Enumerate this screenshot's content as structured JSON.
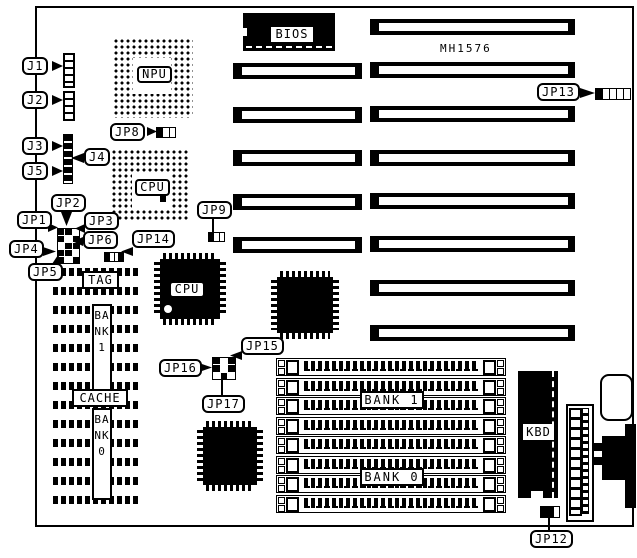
{
  "board": {
    "model": "MH1576"
  },
  "colors": {
    "ink": "#000000",
    "paper": "#ffffff"
  },
  "chips": {
    "bios": "BIOS",
    "npu": "NPU",
    "cpu_socket": "CPU",
    "cpu_qfp": "CPU",
    "tag": "TAG",
    "cache": "CACHE",
    "cache_bank1": "BANK1",
    "cache_bank0": "BANK0",
    "simm_bank1": "BANK 1",
    "simm_bank0": "BANK 0",
    "kbd": "KBD"
  },
  "connectors": {
    "j1": "J1",
    "j2": "J2",
    "j3": "J3",
    "j4": "J4",
    "j5": "J5"
  },
  "jumpers": {
    "jp1": "JP1",
    "jp2": "JP2",
    "jp3": "JP3",
    "jp4": "JP4",
    "jp5": "JP5",
    "jp6": "JP6",
    "jp8": "JP8",
    "jp9": "JP9",
    "jp12": "JP12",
    "jp13": "JP13",
    "jp14": "JP14",
    "jp15": "JP15",
    "jp16": "JP16",
    "jp17": "JP17"
  }
}
